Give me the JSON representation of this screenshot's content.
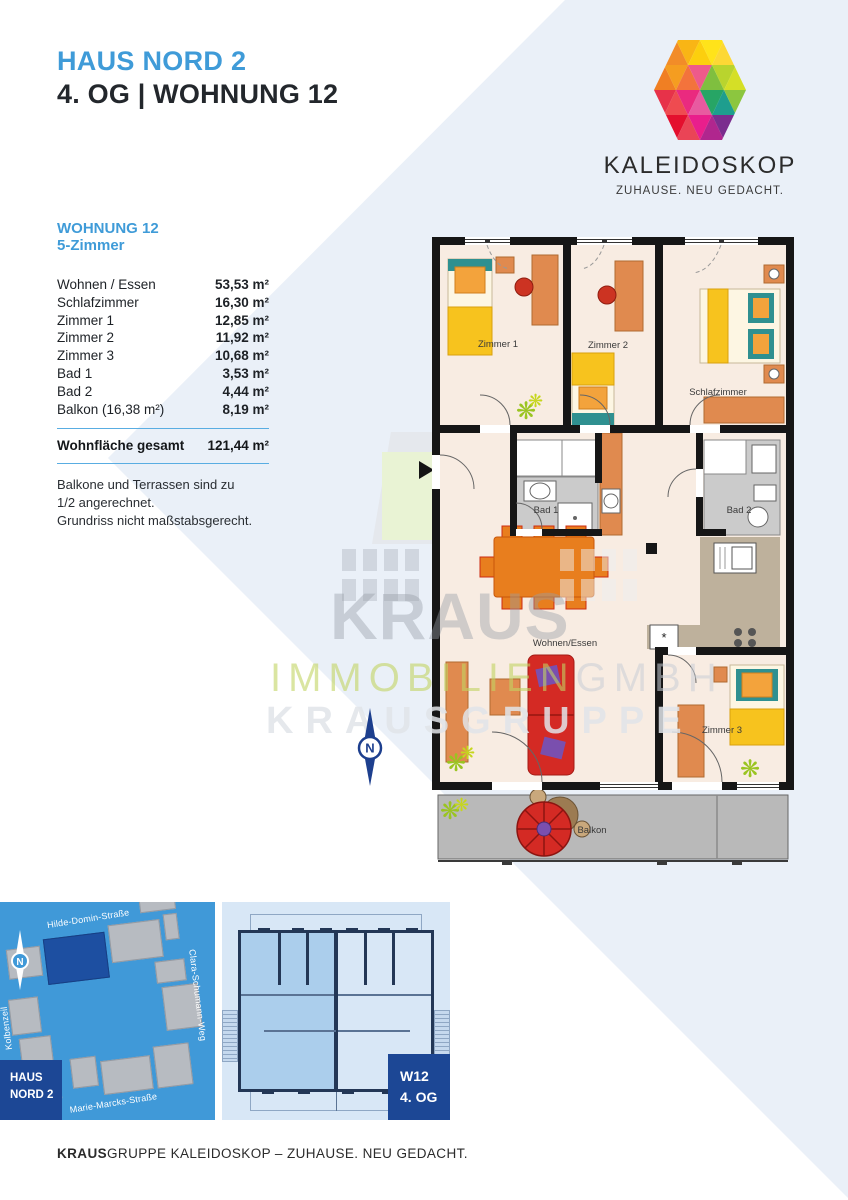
{
  "header": {
    "project": "HAUS NORD 2",
    "unit_line": "4. OG | WOHNUNG 12"
  },
  "logo": {
    "brand": "KALEIDOSKOP",
    "tagline": "ZUHAUSE. NEU GEDACHT."
  },
  "apartment": {
    "title": "WOHNUNG 12",
    "subtitle": "5-Zimmer",
    "rows": [
      {
        "label": "Wohnen / Essen",
        "value": "53,53 m²"
      },
      {
        "label": "Schlafzimmer",
        "value": "16,30 m²"
      },
      {
        "label": "Zimmer 1",
        "value": "12,85 m²"
      },
      {
        "label": "Zimmer 2",
        "value": "11,92 m²"
      },
      {
        "label": "Zimmer 3",
        "value": "10,68 m²"
      },
      {
        "label": "Bad 1",
        "value": "3,53 m²"
      },
      {
        "label": "Bad 2",
        "value": "4,44 m²"
      },
      {
        "label": "Balkon (16,38 m²)",
        "value": "8,19 m²"
      }
    ],
    "total": {
      "label": "Wohnfläche gesamt",
      "value": "121,44 m²"
    },
    "notes": [
      "Balkone und Terrassen sind zu",
      "1/2 angerechnet.",
      "Grundriss nicht maßstabsgerecht."
    ]
  },
  "floorplan": {
    "labels": {
      "zimmer1": "Zimmer 1",
      "zimmer2": "Zimmer 2",
      "schlafzimmer": "Schlafzimmer",
      "bad1": "Bad 1",
      "bad2": "Bad 2",
      "wohnen_essen": "Wohnen/Essen",
      "zimmer3": "Zimmer 3",
      "balkon": "Balkon",
      "kitchen_marker": "*"
    },
    "north": "N"
  },
  "watermark": {
    "line1": "KRAUS",
    "line2_green": "IMMOBILIEN",
    "line2_gray": "GMBH",
    "line3": "KRAUSGRUPPE"
  },
  "site_map": {
    "streets": {
      "top": "Hilde-Domin-Straße",
      "right": "Clara-Schumann-Weg",
      "left": "Kolbenzeil",
      "bottom": "Marie-Marcks-Straße"
    },
    "badge_line1": "HAUS",
    "badge_line2": "NORD 2",
    "north": "N"
  },
  "floor_map": {
    "badge_line1": "W12",
    "badge_line2": "4. OG"
  },
  "footer": {
    "bold": "KRAUS",
    "text": "GRUPPE KALEIDOSKOP – ZUHAUSE. NEU GEDACHT."
  },
  "colors": {
    "accent_blue": "#3f9bd8",
    "navy": "#1c4795",
    "map_blue": "#4099d8",
    "bg_wedge": "#eaf0f8"
  }
}
